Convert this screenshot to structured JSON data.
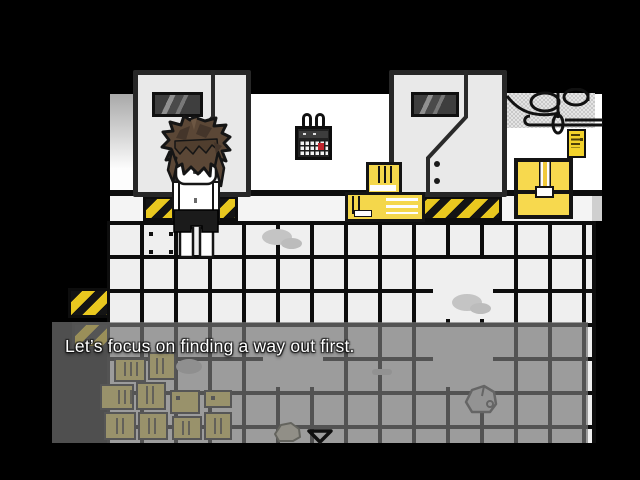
{
  "dialogue": {
    "text": "Let’s focus on finding a way out first.",
    "continue_indicator": "down-triangle"
  },
  "palette": {
    "background": "#000000",
    "wall_white": "#ffffff",
    "door_panel": "#e9e9e9",
    "outline_black": "#141414",
    "floor_tile": "#efefef",
    "floor_grout": "#0d0d0d",
    "hazard_yellow": "#e9c81f",
    "box_yellow": "#f4d74b",
    "overlay_grey": "rgba(116,116,116,0.68)",
    "hair_brown": "#5b4736",
    "eye_blue": "#2f62d8",
    "stain_grey": "#c4c4c4"
  }
}
